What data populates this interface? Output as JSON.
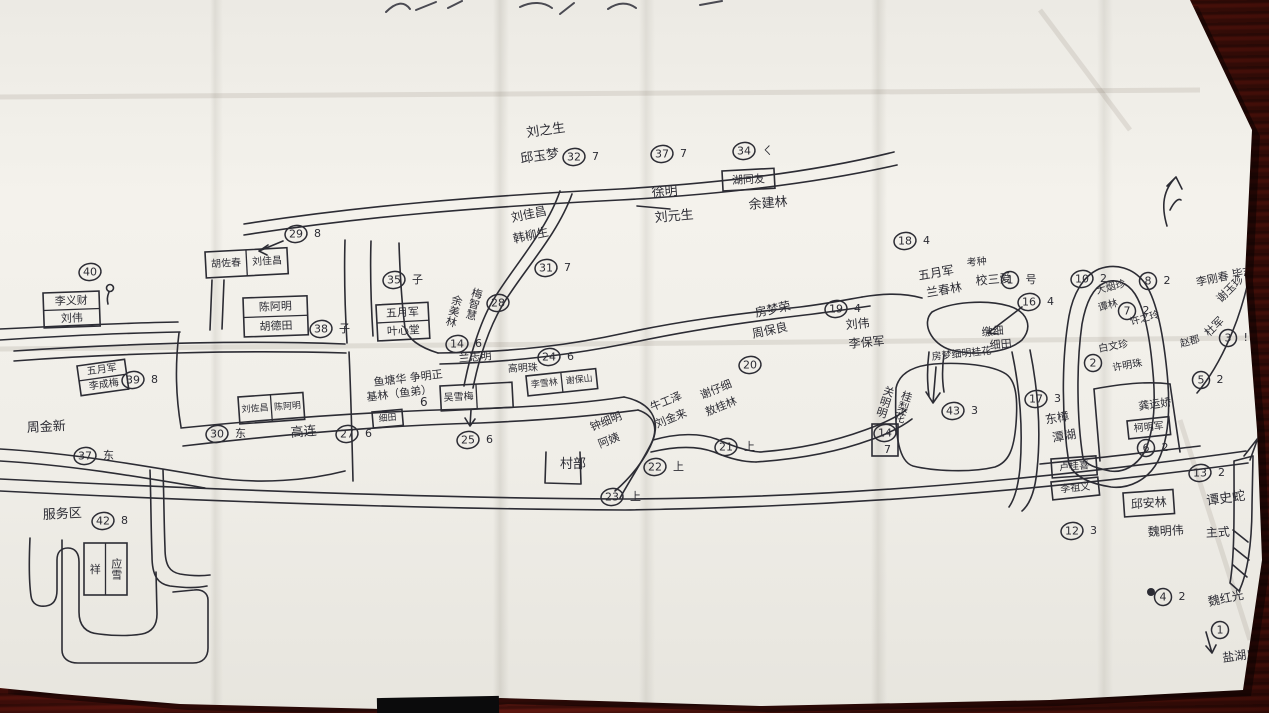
{
  "photo": {
    "description": "hand-drawn village sketch map on creased white paper, photographed on a dark red-brown wooden table",
    "region_note": "bottom of a handwritten title is cut off at the top edge"
  },
  "colors": {
    "ink": "#2c2c34",
    "paper": "#f1efe9",
    "wood": "#4a100c"
  },
  "map": {
    "labels": [
      {
        "t": "刘之生",
        "x": 527,
        "y": 137,
        "s": 13,
        "r": -8
      },
      {
        "t": "邱玉梦",
        "x": 521,
        "y": 163,
        "s": 13,
        "r": -8
      },
      {
        "t": "刘佳昌",
        "x": 512,
        "y": 222,
        "s": 12,
        "r": -12
      },
      {
        "t": "韩柳生",
        "x": 514,
        "y": 243,
        "s": 12,
        "r": -12
      },
      {
        "t": "徐明",
        "x": 652,
        "y": 197,
        "s": 13,
        "r": -5
      },
      {
        "t": "刘元生",
        "x": 655,
        "y": 222,
        "s": 13,
        "r": -5
      },
      {
        "t": "余建林",
        "x": 749,
        "y": 209,
        "s": 13,
        "r": -5
      },
      {
        "t": "梅智慧",
        "x": 478,
        "y": 288,
        "s": 11,
        "r": 15,
        "v": true
      },
      {
        "t": "余美林",
        "x": 458,
        "y": 295,
        "s": 11,
        "r": 15,
        "v": true
      },
      {
        "t": "兰志明",
        "x": 459,
        "y": 362,
        "s": 11,
        "r": -5
      },
      {
        "t": "高明珠",
        "x": 508,
        "y": 372,
        "s": 10,
        "r": -3
      },
      {
        "t": "鱼塘华 争明正",
        "x": 374,
        "y": 386,
        "s": 11,
        "r": -7
      },
      {
        "t": "基林（鱼弟）",
        "x": 367,
        "y": 401,
        "s": 11,
        "r": -7
      },
      {
        "t": "6",
        "x": 420,
        "y": 406,
        "s": 12,
        "r": 0
      },
      {
        "t": "高连",
        "x": 291,
        "y": 437,
        "s": 13,
        "r": -5
      },
      {
        "t": "村部",
        "x": 560,
        "y": 468,
        "s": 13,
        "r": 0
      },
      {
        "t": "钟细明",
        "x": 592,
        "y": 431,
        "s": 11,
        "r": -22
      },
      {
        "t": "阿姨",
        "x": 600,
        "y": 448,
        "s": 11,
        "r": -22
      },
      {
        "t": "牛工泽",
        "x": 652,
        "y": 411,
        "s": 11,
        "r": -22
      },
      {
        "t": "刘金来",
        "x": 657,
        "y": 428,
        "s": 11,
        "r": -22
      },
      {
        "t": "谢仔细",
        "x": 702,
        "y": 399,
        "s": 11,
        "r": -22
      },
      {
        "t": "敖桂林",
        "x": 707,
        "y": 416,
        "s": 11,
        "r": -22
      },
      {
        "t": "房梦荣",
        "x": 756,
        "y": 317,
        "s": 12,
        "r": -12
      },
      {
        "t": "周保良",
        "x": 753,
        "y": 338,
        "s": 12,
        "r": -12
      },
      {
        "t": "刘伟",
        "x": 846,
        "y": 329,
        "s": 12,
        "r": -5
      },
      {
        "t": "李保军",
        "x": 849,
        "y": 348,
        "s": 12,
        "r": -5
      },
      {
        "t": "五月军",
        "x": 919,
        "y": 280,
        "s": 12,
        "r": -10
      },
      {
        "t": "兰春林",
        "x": 927,
        "y": 297,
        "s": 12,
        "r": -10
      },
      {
        "t": "考种",
        "x": 967,
        "y": 266,
        "s": 10,
        "r": -5
      },
      {
        "t": "校三爱",
        "x": 976,
        "y": 285,
        "s": 12,
        "r": -5
      },
      {
        "t": "关明明",
        "x": 890,
        "y": 386,
        "s": 11,
        "r": 18,
        "v": true
      },
      {
        "t": "桂梨花",
        "x": 908,
        "y": 391,
        "s": 11,
        "r": 18,
        "v": true
      },
      {
        "t": "房梦细明桂花",
        "x": 932,
        "y": 360,
        "s": 10,
        "r": -6
      },
      {
        "t": "缴细",
        "x": 982,
        "y": 336,
        "s": 11,
        "r": -5
      },
      {
        "t": "细田",
        "x": 990,
        "y": 349,
        "s": 11,
        "r": -5
      },
      {
        "t": "东樟",
        "x": 1046,
        "y": 424,
        "s": 12,
        "r": -10
      },
      {
        "t": "潭湖",
        "x": 1053,
        "y": 442,
        "s": 12,
        "r": -10
      },
      {
        "t": "龚运娇",
        "x": 1139,
        "y": 410,
        "s": 11,
        "r": -8
      },
      {
        "t": "魏明伟",
        "x": 1148,
        "y": 536,
        "s": 12,
        "r": -3
      },
      {
        "t": "谭史蛇",
        "x": 1207,
        "y": 505,
        "s": 13,
        "r": -8
      },
      {
        "t": "主式",
        "x": 1206,
        "y": 537,
        "s": 12,
        "r": -3
      },
      {
        "t": "魏红光",
        "x": 1209,
        "y": 606,
        "s": 12,
        "r": -12
      },
      {
        "t": "盐湖户",
        "x": 1223,
        "y": 662,
        "s": 12,
        "r": -8
      },
      {
        "t": "李刚春 毕志英",
        "x": 1197,
        "y": 286,
        "s": 11,
        "r": -12
      },
      {
        "t": "大烟珍",
        "x": 1097,
        "y": 294,
        "s": 10,
        "r": -15
      },
      {
        "t": "谭林",
        "x": 1099,
        "y": 311,
        "s": 10,
        "r": -15
      },
      {
        "t": "许之玲",
        "x": 1131,
        "y": 325,
        "s": 10,
        "r": -15
      },
      {
        "t": "白文珍",
        "x": 1099,
        "y": 352,
        "s": 10,
        "r": -10
      },
      {
        "t": "许明珠",
        "x": 1113,
        "y": 371,
        "s": 10,
        "r": -10
      },
      {
        "t": "谢玉珍",
        "x": 1221,
        "y": 303,
        "s": 11,
        "r": -45
      },
      {
        "t": "杜军",
        "x": 1209,
        "y": 337,
        "s": 11,
        "r": -45
      },
      {
        "t": "赵郡",
        "x": 1181,
        "y": 347,
        "s": 10,
        "r": -15
      },
      {
        "t": "服务区",
        "x": 43,
        "y": 519,
        "s": 13,
        "r": -3
      },
      {
        "t": "周金新",
        "x": 27,
        "y": 432,
        "s": 13,
        "r": -3
      },
      {
        "t": "7",
        "x": 884,
        "y": 453,
        "s": 11,
        "r": 0
      }
    ],
    "circled_numbers": [
      {
        "n": "40",
        "suffix": "",
        "x": 90,
        "y": 272
      },
      {
        "n": "29",
        "suffix": "8",
        "x": 296,
        "y": 234
      },
      {
        "n": "35",
        "suffix": "子",
        "x": 394,
        "y": 280
      },
      {
        "n": "38",
        "suffix": "子",
        "x": 321,
        "y": 329
      },
      {
        "n": "39",
        "suffix": "8",
        "x": 133,
        "y": 380
      },
      {
        "n": "37",
        "suffix": "东",
        "x": 85,
        "y": 456
      },
      {
        "n": "30",
        "suffix": "东",
        "x": 217,
        "y": 434
      },
      {
        "n": "27",
        "suffix": "6",
        "x": 347,
        "y": 434
      },
      {
        "n": "14",
        "suffix": "6",
        "x": 457,
        "y": 344
      },
      {
        "n": "24",
        "suffix": "6",
        "x": 549,
        "y": 357
      },
      {
        "n": "25",
        "suffix": "6",
        "x": 468,
        "y": 440
      },
      {
        "n": "28",
        "suffix": "",
        "x": 498,
        "y": 303
      },
      {
        "n": "31",
        "suffix": "7",
        "x": 546,
        "y": 268
      },
      {
        "n": "32",
        "suffix": "7",
        "x": 574,
        "y": 157
      },
      {
        "n": "37",
        "suffix": "7",
        "x": 662,
        "y": 154
      },
      {
        "n": "34",
        "suffix": "ㄑ",
        "x": 744,
        "y": 151
      },
      {
        "n": "18",
        "suffix": "4",
        "x": 905,
        "y": 241
      },
      {
        "n": "19",
        "suffix": "4",
        "x": 836,
        "y": 309
      },
      {
        "n": "20",
        "suffix": "",
        "x": 750,
        "y": 365
      },
      {
        "n": "21",
        "suffix": "上",
        "x": 726,
        "y": 447
      },
      {
        "n": "22",
        "suffix": "上",
        "x": 655,
        "y": 467
      },
      {
        "n": "23",
        "suffix": "上",
        "x": 612,
        "y": 497
      },
      {
        "n": "16",
        "suffix": "4",
        "x": 1029,
        "y": 302
      },
      {
        "n": "1",
        "suffix": "号",
        "x": 1010,
        "y": 280
      },
      {
        "n": "17",
        "suffix": "3",
        "x": 1036,
        "y": 399
      },
      {
        "n": "43",
        "suffix": "3",
        "x": 953,
        "y": 411
      },
      {
        "n": "42",
        "suffix": "8",
        "x": 103,
        "y": 521
      },
      {
        "n": "6",
        "suffix": "2",
        "x": 1146,
        "y": 448
      },
      {
        "n": "13",
        "suffix": "2",
        "x": 1200,
        "y": 473
      },
      {
        "n": "12",
        "suffix": "3",
        "x": 1072,
        "y": 531
      },
      {
        "n": "8",
        "suffix": "2",
        "x": 1148,
        "y": 281
      },
      {
        "n": "10",
        "suffix": "2",
        "x": 1082,
        "y": 279
      },
      {
        "n": "7",
        "suffix": "2",
        "x": 1127,
        "y": 311
      },
      {
        "n": "2",
        "suffix": "",
        "x": 1093,
        "y": 363
      },
      {
        "n": "5",
        "suffix": "2",
        "x": 1201,
        "y": 380
      },
      {
        "n": "3",
        "suffix": "!",
        "x": 1228,
        "y": 338
      },
      {
        "n": "4",
        "suffix": "2",
        "x": 1163,
        "y": 597
      },
      {
        "n": "14",
        "suffix": "",
        "x": 885,
        "y": 433
      },
      {
        "n": "1",
        "suffix": "",
        "x": 1220,
        "y": 630
      }
    ],
    "boxes": [
      {
        "x": 205,
        "y": 252,
        "w": 82,
        "h": 26,
        "rot": -3,
        "dir": "cols",
        "cells": [
          "胡佐春",
          "刘佳昌"
        ],
        "fs": 10
      },
      {
        "x": 243,
        "y": 298,
        "w": 64,
        "h": 39,
        "rot": -2,
        "dir": "rows",
        "cells": [
          "陈阿明",
          "胡德田"
        ],
        "fs": 11
      },
      {
        "x": 376,
        "y": 305,
        "w": 52,
        "h": 36,
        "rot": -3,
        "dir": "rows",
        "cells": [
          "五月军",
          "叶心堂"
        ],
        "fs": 11
      },
      {
        "x": 43,
        "y": 293,
        "w": 56,
        "h": 35,
        "rot": -2,
        "dir": "rows",
        "cells": [
          "李义财",
          "刘伟"
        ],
        "fs": 11
      },
      {
        "x": 77,
        "y": 366,
        "w": 48,
        "h": 30,
        "rot": -8,
        "dir": "rows",
        "cells": [
          "五月军",
          "李成梅"
        ],
        "fs": 10
      },
      {
        "x": 238,
        "y": 397,
        "w": 65,
        "h": 27,
        "rot": -4,
        "dir": "cols",
        "cells": [
          "刘佐昌",
          "陈阿明"
        ],
        "fs": 9
      },
      {
        "x": 440,
        "y": 386,
        "w": 72,
        "h": 25,
        "rot": -3,
        "dir": "cols",
        "cells": [
          "吴雪梅",
          ""
        ],
        "fs": 10
      },
      {
        "x": 526,
        "y": 376,
        "w": 70,
        "h": 20,
        "rot": -6,
        "dir": "cols",
        "cells": [
          "李雪林",
          "谢保山"
        ],
        "fs": 9
      },
      {
        "x": 372,
        "y": 412,
        "w": 30,
        "h": 16,
        "rot": -5,
        "dir": "cols",
        "cells": [
          "细田"
        ],
        "fs": 9
      },
      {
        "x": 722,
        "y": 171,
        "w": 52,
        "h": 20,
        "rot": -3,
        "dir": "cols",
        "cells": [
          "湖同友"
        ],
        "fs": 11
      },
      {
        "x": 1127,
        "y": 421,
        "w": 42,
        "h": 18,
        "rot": -6,
        "dir": "cols",
        "cells": [
          "柯明军"
        ],
        "fs": 10
      },
      {
        "x": 1051,
        "y": 459,
        "w": 45,
        "h": 19,
        "rot": -4,
        "dir": "cols",
        "cells": [
          "卢桂喜"
        ],
        "fs": 10
      },
      {
        "x": 1051,
        "y": 482,
        "w": 47,
        "h": 18,
        "rot": -6,
        "dir": "cols",
        "cells": [
          "李祖义"
        ],
        "fs": 10
      },
      {
        "x": 1123,
        "y": 493,
        "w": 50,
        "h": 24,
        "rot": -4,
        "dir": "cols",
        "cells": [
          "邱安林"
        ],
        "fs": 12
      },
      {
        "x": 84,
        "y": 543,
        "w": 43,
        "h": 52,
        "rot": 0,
        "dir": "cols",
        "cells": [
          "祥",
          "应雪"
        ],
        "fs": 11,
        "vertical": true
      },
      {
        "x": 872,
        "y": 424,
        "w": 26,
        "h": 32,
        "rot": 0,
        "dir": "cols",
        "cells": [
          ""
        ],
        "fs": 10
      }
    ]
  }
}
